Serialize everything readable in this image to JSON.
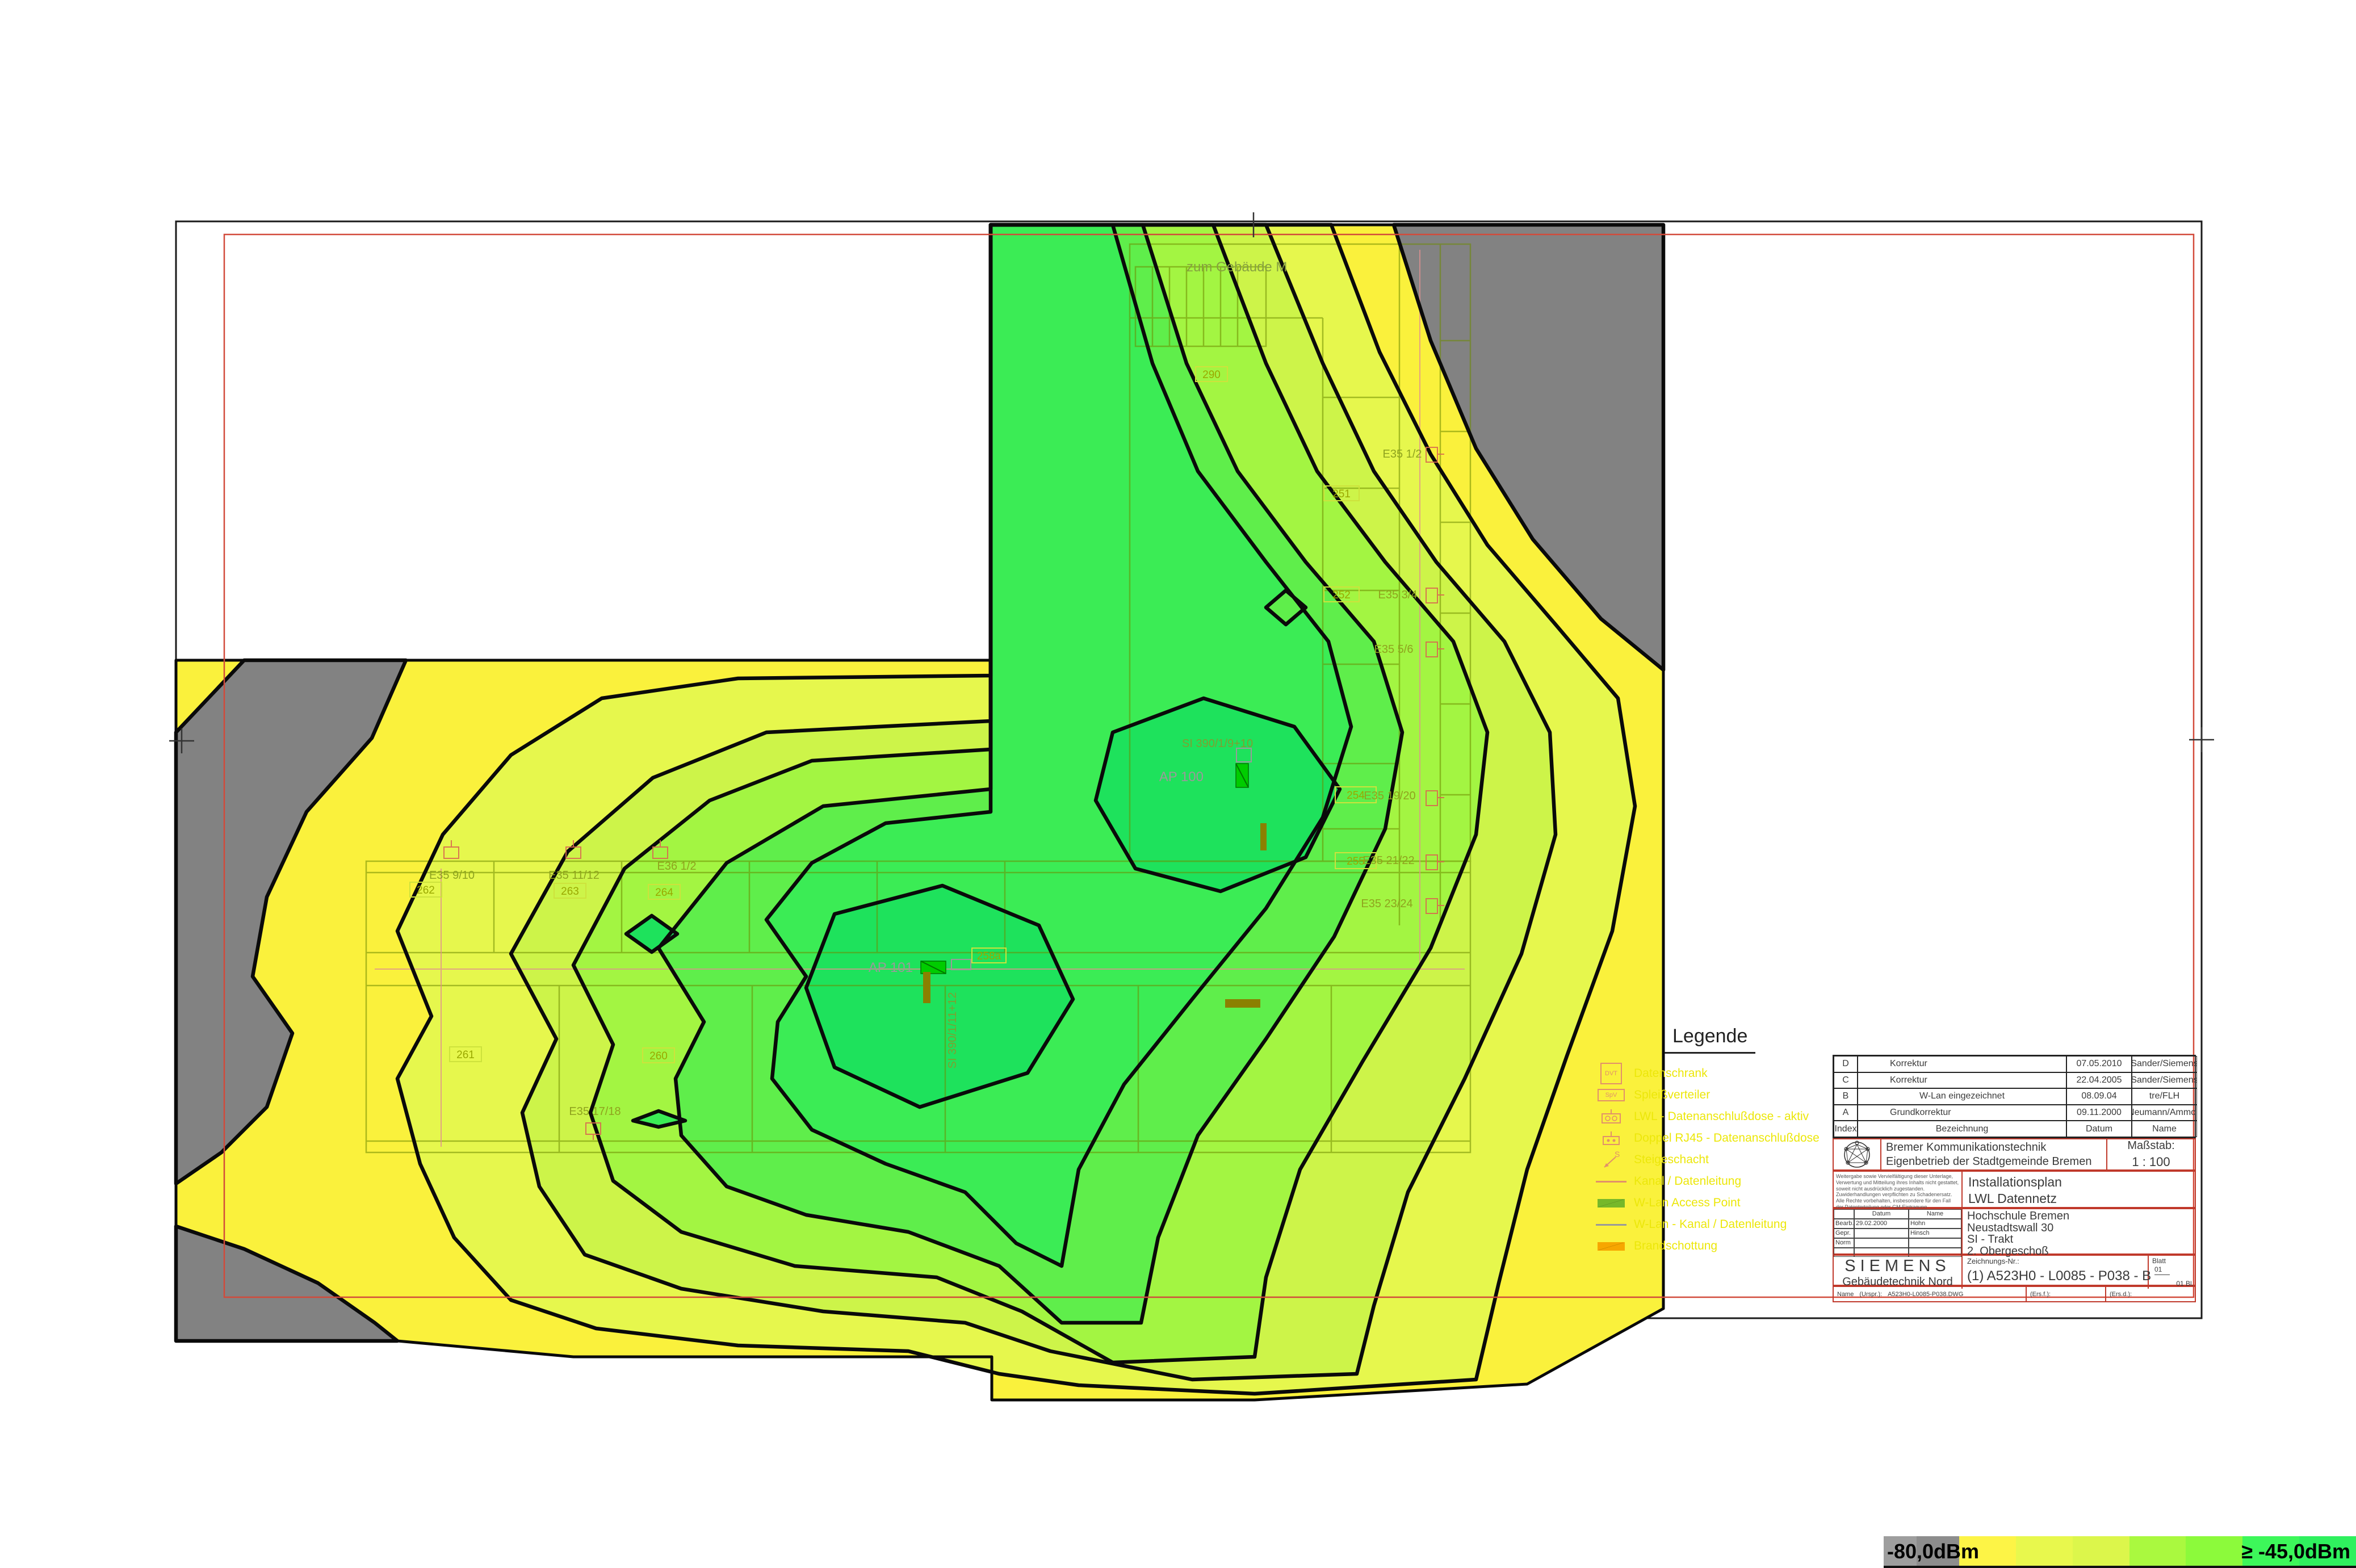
{
  "map": {
    "levels": {
      "gray": "#828282",
      "yellow": "#FAF13C",
      "yg1": "#E6F74D",
      "yg2": "#CDF449",
      "g1": "#A3F542",
      "g2": "#5FEE4B",
      "g3": "#3BEC55",
      "g4": "#1EE25C"
    },
    "annotation": "zum Gebäude M",
    "aps": [
      "AP 100",
      "AP 101"
    ],
    "risers": [
      "SI 390/1/9+10",
      "SI 390/1/11+12"
    ],
    "rooms": [
      "290",
      "251",
      "252",
      "254",
      "255",
      "258a",
      "262",
      "263",
      "264",
      "261",
      "260"
    ],
    "outlets": [
      "E35 1/2",
      "E35 3/4",
      "E35 5/6",
      "E35 19/20",
      "E35 21/22",
      "E35 23/24",
      "E35 9/10",
      "E35 11/12",
      "E36 1/2",
      "E35 17/18"
    ]
  },
  "legend": {
    "title": "Legende",
    "sym_dvt": "DVT",
    "sym_spv": "SpV",
    "sym_s": "S",
    "items": [
      {
        "icon": "data-cabinet-icon",
        "label": "Datenschrank"
      },
      {
        "icon": "splice-distributor-icon",
        "label": "Spleißverteiler"
      },
      {
        "icon": "lwl-outlet-icon",
        "label": "LWL - Datenanschlußdose - aktiv"
      },
      {
        "icon": "rj45-outlet-icon",
        "label": "Doppel RJ45 - Datenanschlußdose"
      },
      {
        "icon": "riser-shaft-icon",
        "label": "Steigeschacht"
      },
      {
        "icon": "cable-duct-icon",
        "label": "Kanal / Datenleitung"
      },
      {
        "icon": "access-point-icon",
        "label": "W-Lan Access Point"
      },
      {
        "icon": "wlan-duct-icon",
        "label": "W-Lan - Kanal / Datenleitung"
      },
      {
        "icon": "firestop-icon",
        "label": "Brandschottung"
      }
    ],
    "colors": {
      "symbol": "#e2906a",
      "access_point": "#76b82a",
      "firestop": "#f7a600",
      "wlan_line": "#999999",
      "label": "#ece70a"
    }
  },
  "titleblock": {
    "revisions": [
      {
        "index": "D",
        "bezeichnung": "Korrektur",
        "datum": "07.05.2010",
        "name": "Sander/Siemens"
      },
      {
        "index": "C",
        "bezeichnung": "Korrektur",
        "datum": "22.04.2005",
        "name": "Sander/Siemens"
      },
      {
        "index": "B",
        "bezeichnung": "W-Lan eingezeichnet",
        "datum": "08.09.04",
        "name": "tre/FLH"
      },
      {
        "index": "A",
        "bezeichnung": "Grundkorrektur",
        "datum": "09.11.2000",
        "name": "Neumann/Ammon"
      },
      {
        "index": "Index",
        "bezeichnung": "Bezeichnung",
        "datum": "Datum",
        "name": "Name"
      }
    ],
    "company_line1": "Bremer Kommunikationstechnik",
    "company_line2": "Eigenbetrieb der Stadtgemeinde Bremen",
    "masstab_label": "Maßstab:",
    "masstab_value": "1 : 100",
    "disclaimer": "Weitergabe sowie Vervielfältigung dieser Unterlage, Verwertung und Mitteilung ihres Inhalts nicht gestattet, soweit nicht ausdrücklich zugestanden. Zuwiderhandlungen verpflichten zu Schadenersatz. Alle Rechte vorbehalten, insbesondere für den Fall der Patenterteilung oder GM-Eintragung.",
    "plan_title_line1": "Installationsplan",
    "plan_title_line2": "LWL Datennetz",
    "approval": {
      "datum_header": "Datum",
      "name_header": "Name",
      "rows": [
        {
          "label": "Bearb.",
          "datum": "29.02.2000",
          "name": "Hohn"
        },
        {
          "label": "Gepr.",
          "datum": "",
          "name": "Hinsch"
        },
        {
          "label": "Norm",
          "datum": "",
          "name": ""
        }
      ]
    },
    "project_line1": "Hochschule Bremen",
    "project_line2": "Neustadtswall 30",
    "project_line3": "SI - Trakt",
    "project_line4": "2. Obergeschoß",
    "siemens": "SIEMENS",
    "siemens_sub": "Gebäudetechnik Nord",
    "zeichnungsnr_label": "Zeichnungs-Nr.:",
    "zeichnungsnr": "(1) A523H0 - L0085 - P038 - B",
    "blatt_label": "Blatt",
    "blatt_value": "01",
    "blatt_total": "01 Bl.",
    "footer_name_label": "Name",
    "footer_ursp_label": "(Urspr.):",
    "footer_ursp_value": "A523H0-L0085-P038.DWG",
    "footer_ersf_label": "(Ers.f.):",
    "footer_ersd_label": "(Ers.d.):"
  },
  "scalebar": {
    "min_label": "-80,0dBm",
    "max_label": "≥ -45,0dBm",
    "segments": [
      "#9e9e9e",
      "#8d8d8d",
      "#fdf446",
      "#e8f84d",
      "#dcf64b",
      "#aaf93f",
      "#8cfa3b",
      "#3df75a",
      "#2ff05e"
    ]
  }
}
